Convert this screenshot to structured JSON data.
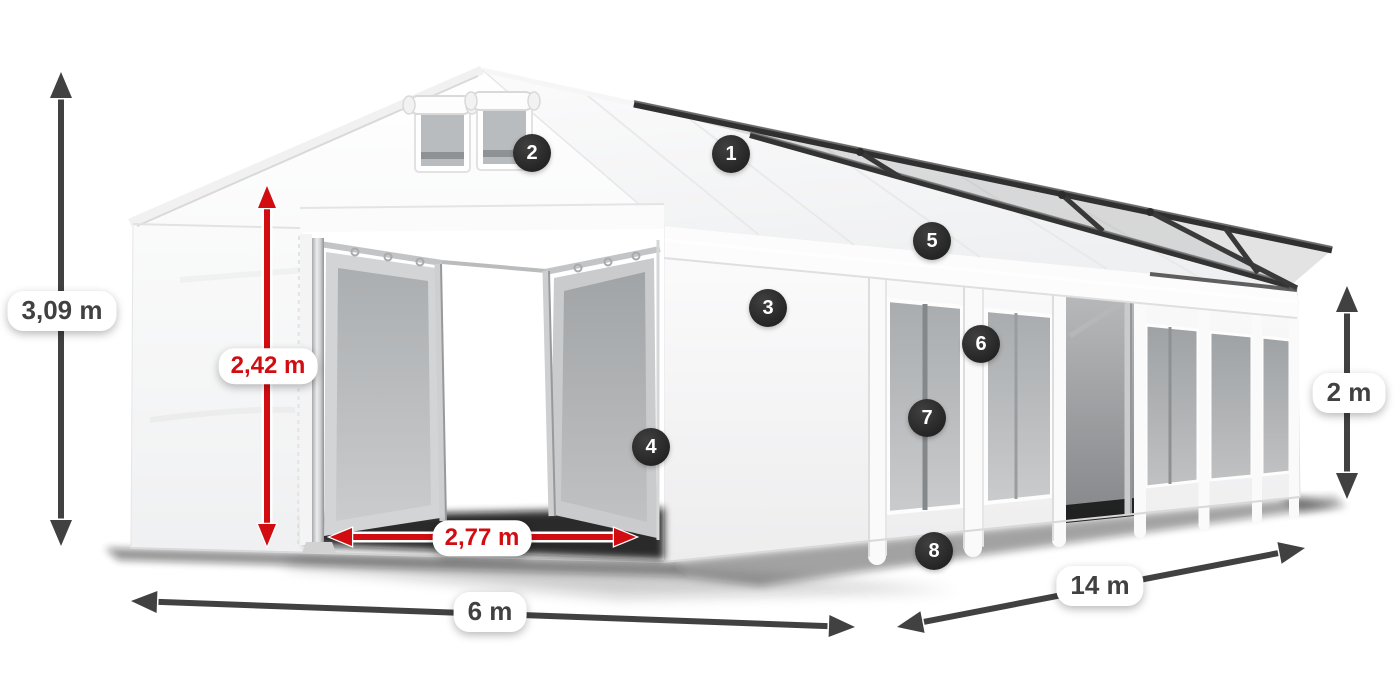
{
  "canvas": {
    "width": 1400,
    "height": 700,
    "background": "#ffffff"
  },
  "palette": {
    "dimension_gray": "#414141",
    "dimension_red": "#d20d12",
    "badge_background": "#2b2b2b",
    "badge_text": "#ffffff",
    "label_pill_background": "#ffffff",
    "tent_fabric": "#f5f5f6",
    "mesh_panel_gray": "#b3b6b8",
    "frame_dark": "#333333"
  },
  "dimensions": {
    "total_height": {
      "label": "3,09 m",
      "style": "gray"
    },
    "door_height": {
      "label": "2,42 m",
      "style": "red"
    },
    "door_width": {
      "label": "2,77 m",
      "style": "red"
    },
    "front_width": {
      "label": "6 m",
      "style": "gray"
    },
    "side_length": {
      "label": "14 m",
      "style": "gray"
    },
    "side_wall_height": {
      "label": "2 m",
      "style": "gray"
    }
  },
  "callouts": [
    {
      "n": "1"
    },
    {
      "n": "2"
    },
    {
      "n": "3"
    },
    {
      "n": "4"
    },
    {
      "n": "5"
    },
    {
      "n": "6"
    },
    {
      "n": "7"
    },
    {
      "n": "8"
    }
  ]
}
